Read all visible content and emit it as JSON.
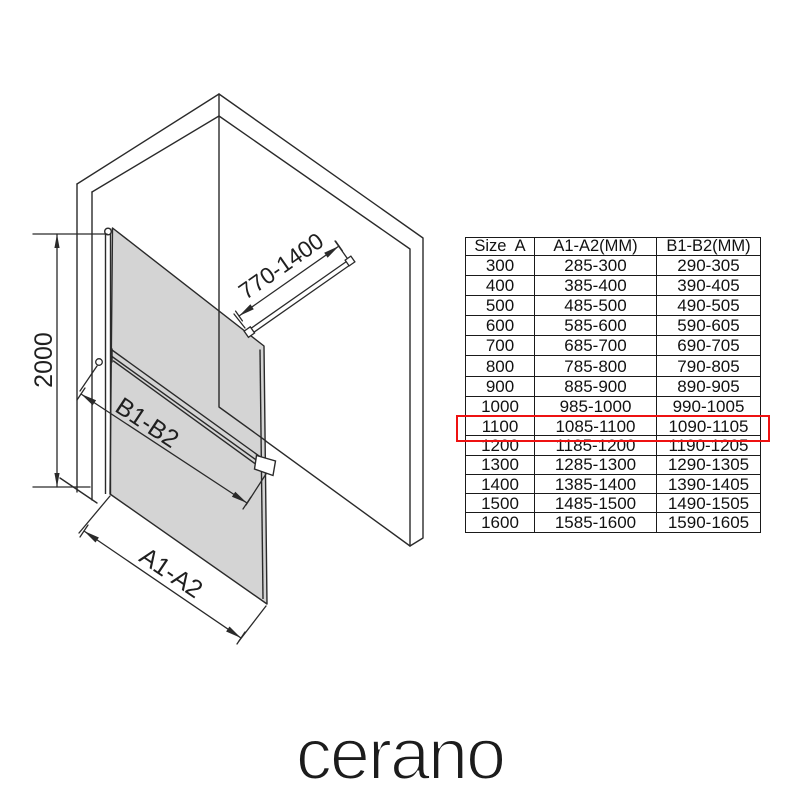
{
  "diagram": {
    "labels": {
      "support_bar_range": "770-1400",
      "height_mm": "2000",
      "bar_range_label": "B1-B2",
      "glass_range_label": "A1-A2"
    },
    "colors": {
      "glass": "#d4d4d4",
      "line": "#2a2a2a"
    }
  },
  "table": {
    "headers": [
      "Size  A",
      "A1-A2(MM)",
      "B1-B2(MM)"
    ],
    "rows": [
      [
        "300",
        "285-300",
        "290-305"
      ],
      [
        "400",
        "385-400",
        "390-405"
      ],
      [
        "500",
        "485-500",
        "490-505"
      ],
      [
        "600",
        "585-600",
        "590-605"
      ],
      [
        "700",
        "685-700",
        "690-705"
      ],
      [
        "800",
        "785-800",
        "790-805"
      ],
      [
        "900",
        "885-900",
        "890-905"
      ],
      [
        "1000",
        "985-1000",
        "990-1005"
      ],
      [
        "1100",
        "1085-1100",
        "1090-1105"
      ],
      [
        "1200",
        "1185-1200",
        "1190-1205"
      ],
      [
        "1300",
        "1285-1300",
        "1290-1305"
      ],
      [
        "1400",
        "1385-1400",
        "1390-1405"
      ],
      [
        "1500",
        "1485-1500",
        "1490-1505"
      ],
      [
        "1600",
        "1585-1600",
        "1590-1605"
      ]
    ],
    "highlighted_size": "1100",
    "highlight_index": 8,
    "highlight_color": "#ee1111"
  },
  "logo": {
    "text": "cerano"
  }
}
